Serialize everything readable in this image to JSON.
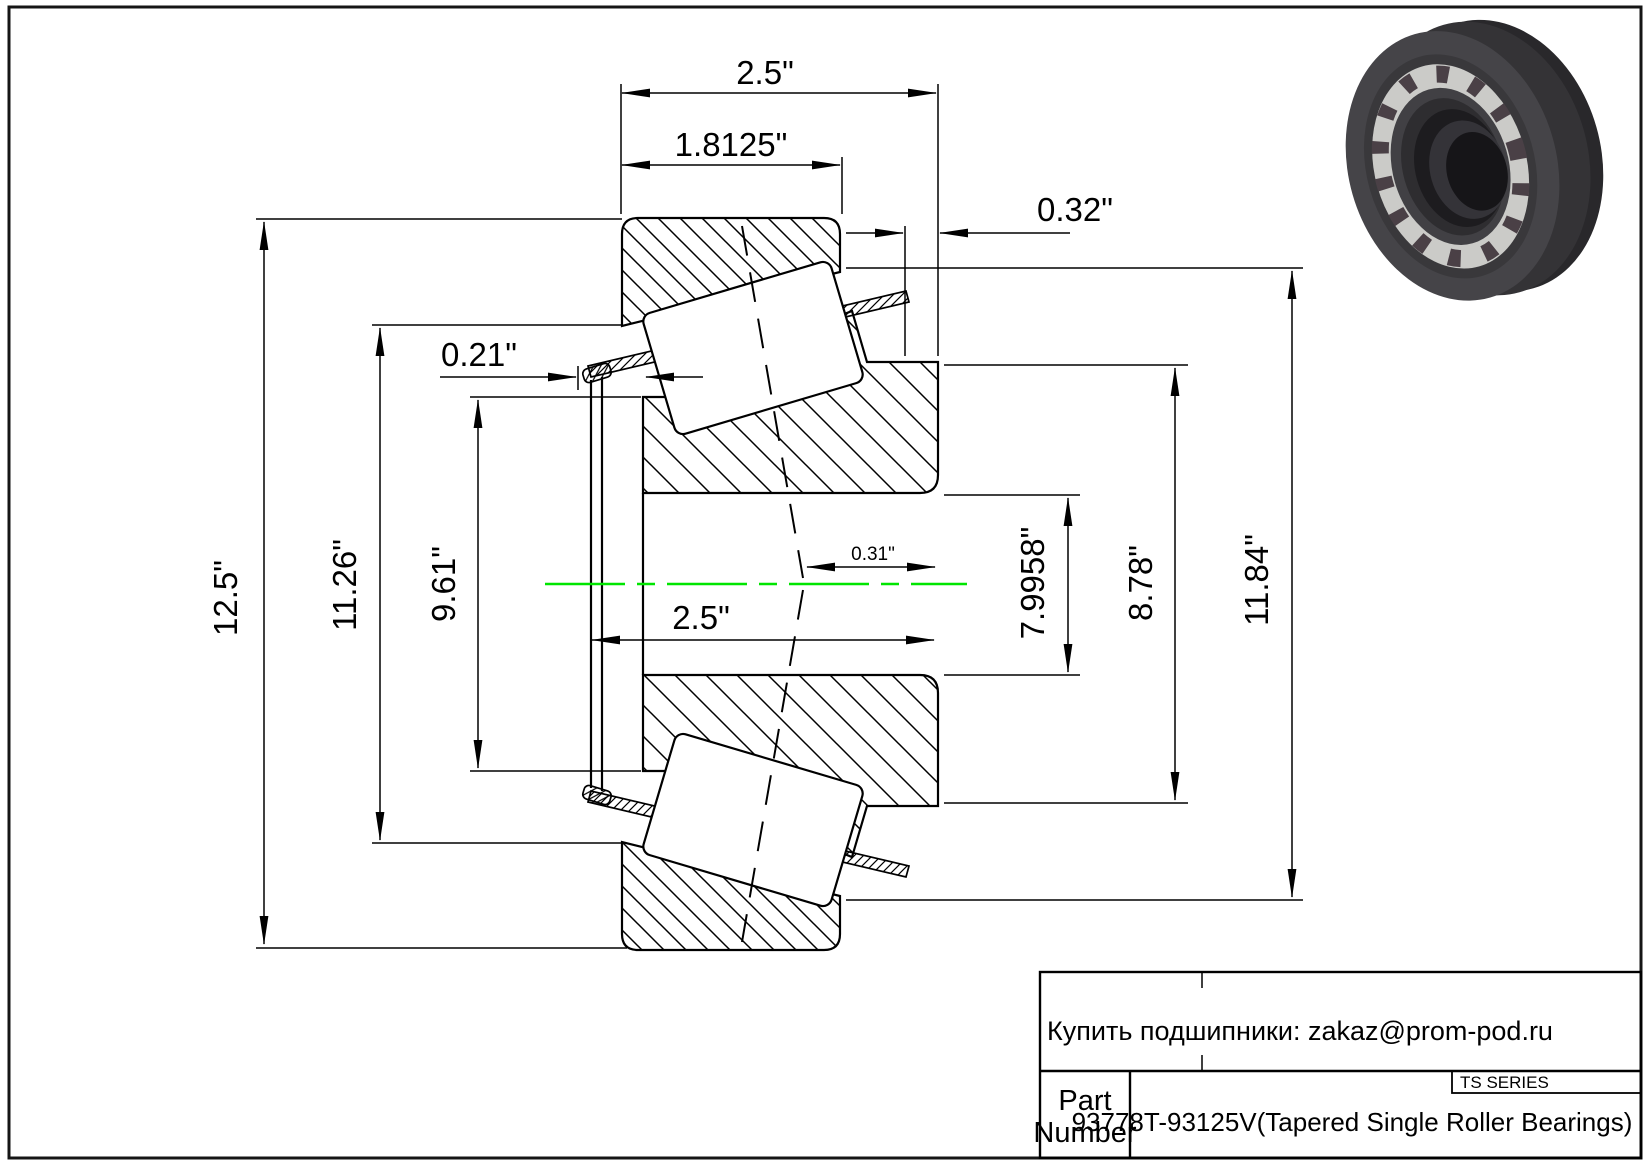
{
  "page": {
    "background": "#ffffff",
    "line_color": "#000000",
    "centerline_color": "#00e500"
  },
  "drawing": {
    "type": "tapered-roller-bearing-cross-section",
    "dimensions": {
      "overall_width_top": "2.5\"",
      "cup_width": "1.8125\"",
      "cup_front_standout": "0.32\"",
      "cage_back_standout": "0.21\"",
      "outer_diameter": "12.5\"",
      "left_race_diameter": "11.26\"",
      "cone_back_od": "9.61\"",
      "bore_width": "2.5\"",
      "center_offset": "0.31\"",
      "bore_diameter": "7.9958\"",
      "cone_front_od": "8.78\"",
      "cup_race_diameter": "11.84\""
    }
  },
  "title_block": {
    "contact": "Купить подшипники: zakaz@prom-pod.ru",
    "series_label": "TS SERIES",
    "part_number_label_line1": "Part",
    "part_number_label_line2": "Number",
    "part_number_value": "93778T-93125V(Tapered Single Roller Bearings)"
  }
}
